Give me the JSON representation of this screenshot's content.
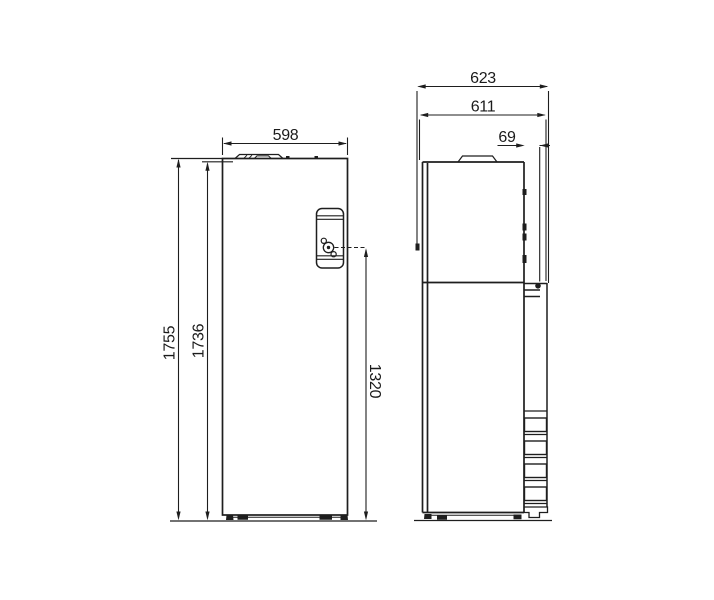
{
  "diagram": {
    "kind": "appliance-dimension-drawing",
    "colors": {
      "line": "#1e1e1e",
      "background": "#ffffff"
    },
    "front": {
      "width": "598",
      "total_height": "1755",
      "body_height": "1736",
      "panel_height": "1320"
    },
    "side": {
      "total_depth": "623",
      "body_depth": "611",
      "rear_offset": "69"
    }
  }
}
